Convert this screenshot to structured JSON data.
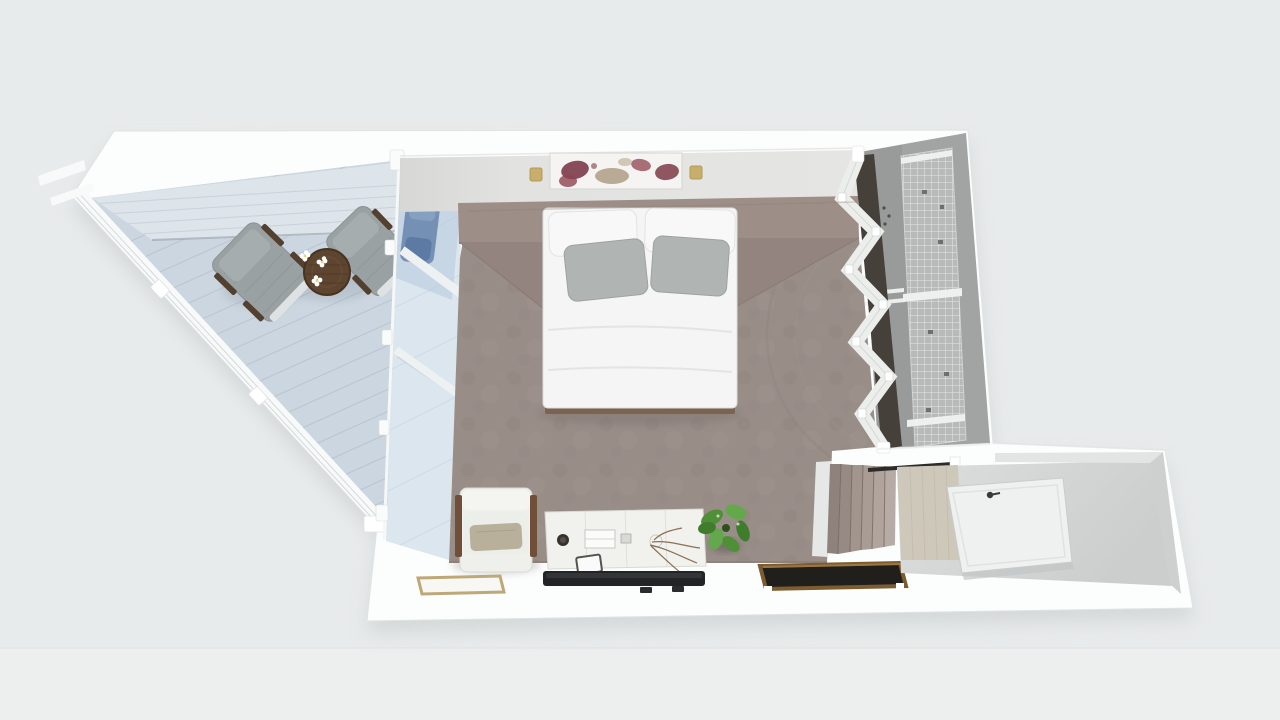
{
  "scene": {
    "type": "3d-floorplan-top-down-render",
    "rooms": [
      {
        "id": "balcony",
        "label": "balcony deck with railing"
      },
      {
        "id": "bedroom",
        "label": "carpeted bedroom"
      },
      {
        "id": "closet",
        "label": "walk-in closet with bifold doors and wire shelving"
      },
      {
        "id": "entry",
        "label": "entry hall with open door"
      },
      {
        "id": "stairs",
        "label": "carpeted staircase"
      }
    ],
    "furniture": [
      "double bed with white duvet, two white pillows, two gray pillows",
      "upholstered headboard platform",
      "abstract wall art with two gold sconces",
      "white armchair with wood arms and beige pillow",
      "white dresser with decor items",
      "flat tv on wall below dresser",
      "green plant",
      "dark wood desk",
      "light wood tray shelf",
      "two wicker balcony chairs",
      "round dark wood balcony table with white flowers",
      "blue chair at glass wall",
      "glass wall between balcony and bedroom",
      "open white entry door"
    ]
  },
  "colors": {
    "bg": "#e8ebeb",
    "bg2": "#edefef",
    "shadow": "#c3c9c9",
    "wall": "#fcfdfd",
    "wallEdge": "#e0e3e3",
    "wallFace": "#e0e0de",
    "deck": "#ccd6e0",
    "deckLight": "#dde4ea",
    "deckLine": "#b4c1cd",
    "rail": "#f8fafa",
    "railSlat": "#d3d9db",
    "glass": "#aec3d6",
    "glassStrip": "#dce6ee",
    "glassLine": "#f6f8f8",
    "carpet": "#998d88",
    "carpetEdge": "#857a74",
    "headboard": "#9e8e88",
    "headboardShade": "#948480",
    "bedWhite": "#f4f5f4",
    "pillowWhite": "#f7f8f7",
    "pillowGray": "#b0b4b3",
    "bedFrame": "#7b6350",
    "art": "#f5f4f2",
    "artBurgundy": "#7c3a49",
    "artBurgundy2": "#8d4350",
    "artBeige": "#b3a28c",
    "sconce": "#c8ae6d",
    "wicker": "#9aa1a3",
    "wickerLine": "#8a9194",
    "chairFrame": "#53402e",
    "tableWood": "#5d4530",
    "flower": "#ffffff",
    "armWhite": "#eff0ec",
    "armPillow": "#b8b09a",
    "armWood": "#6f4f37",
    "dresser": "#f1f1ed",
    "tvDark": "#222426",
    "tvSheen": "#3a3d40",
    "tray": "#bfa878",
    "deskWood": "#7d5c31",
    "deskTop": "#211f1c",
    "plant1": "#4f8f38",
    "plant2": "#63a84b",
    "plant3": "#3f7c2b",
    "twig": "#7a5a3a",
    "closetFloor": "#a2a4a3",
    "closetFloorDark": "#8f9192",
    "shelf": "#b7bab9",
    "grid": "#eef0ef",
    "doorWhite": "#eceeec",
    "doorGap": "#46403a",
    "stairDark": "#8f827c",
    "stairMid": "#a2958e",
    "stairLight": "#b7aca5",
    "stairSep": "#74675f",
    "entryFloor": "#d8dad9",
    "entryWood": "#cec8bb",
    "entryWall": "#e3e5e4",
    "doorLeaf": "#eff1f0",
    "handle": "#3a3a38",
    "blueChair": "#7590b5",
    "blueChairDark": "#5d7aa4"
  }
}
